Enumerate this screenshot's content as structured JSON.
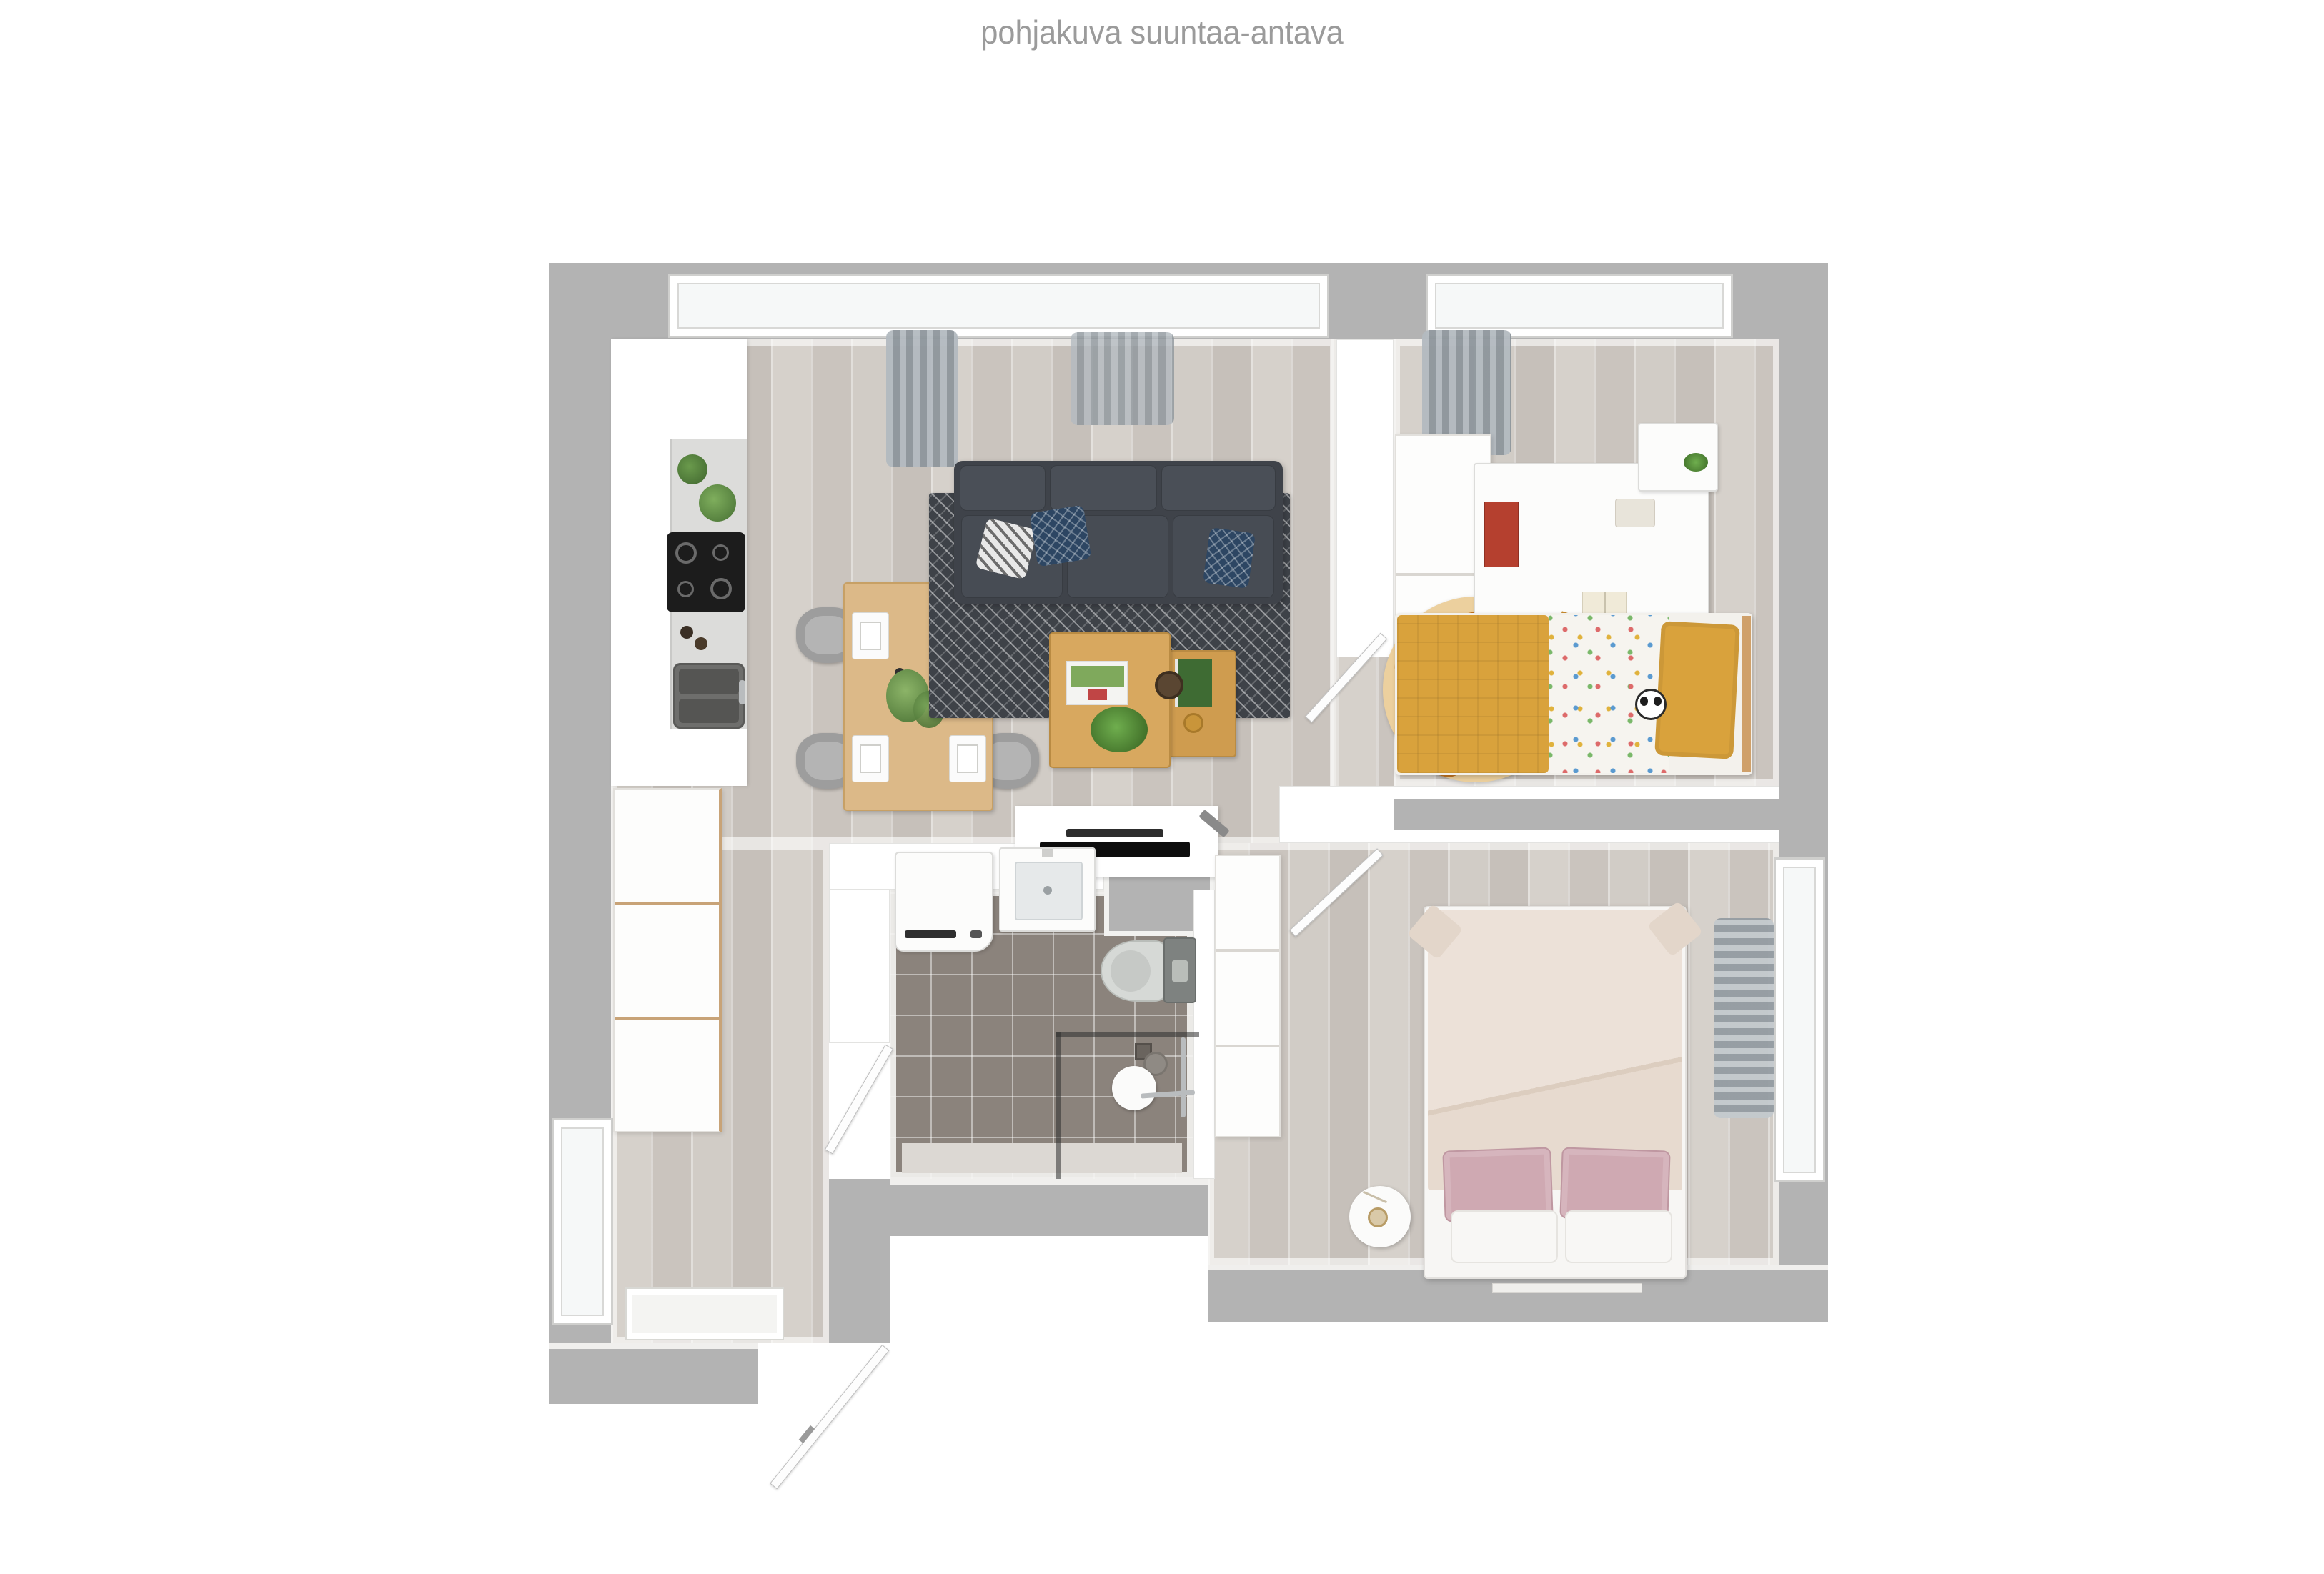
{
  "title": "pohjakuva suuntaa-antava",
  "colors": {
    "background": "#ffffff",
    "title_text": "#9b9b9b",
    "outer_wall": "#b3b3b3",
    "inner_wall": "#ffffff",
    "wood_floor": "#d0cbc5",
    "bathroom_tile": "#8b837c",
    "sofa": "#3f434a",
    "rug": "#3e4248",
    "dining_table_wood": "#dcb988",
    "coffee_table_wood": "#d8a85f",
    "kids_accent_mustard": "#d9a23c",
    "giraffe_rug_base": "#ecd09e",
    "giraffe_rug_spot": "#c57623",
    "bedroom_duvet_cream": "#ece1d8",
    "bedroom_pillow_pink": "#cfa9b2",
    "curtain_gray": "#9aa1a7"
  },
  "plan": {
    "type": "apartment-floor-plan-3d-top-view",
    "rooms": {
      "kitchen_living": [
        "kitchen-counter",
        "cooktop",
        "kitchen-sink",
        "counter-plants",
        "dining-table",
        "dining-chairs",
        "place-settings",
        "sofa",
        "throw-pillows",
        "area-rug",
        "coffee-table-large",
        "coffee-table-small",
        "tv-console",
        "tv",
        "window",
        "curtains"
      ],
      "kids_room": [
        "wardrobe",
        "desk",
        "desk-chair",
        "drawer-unit",
        "giraffe-rug",
        "single-bed",
        "panda-toy",
        "window",
        "curtain",
        "door"
      ],
      "bathroom": [
        "washing-machine",
        "washbasin",
        "toilet",
        "shower-enclosure",
        "shower-fixtures",
        "door"
      ],
      "bedroom": [
        "double-bed",
        "pink-pillows",
        "white-pillows",
        "bedside-table",
        "table-lamp",
        "hall-closet",
        "window",
        "curtain",
        "door"
      ],
      "entry": [
        "entry-wardrobes",
        "doormat",
        "front-door",
        "side-window"
      ]
    }
  }
}
